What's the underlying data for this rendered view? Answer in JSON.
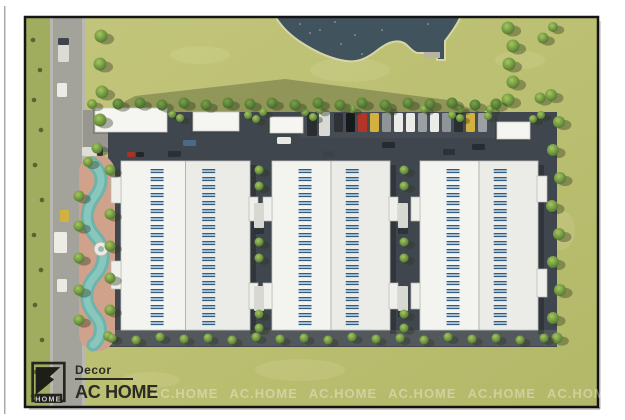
{
  "branding": {
    "brand_top": "Decor",
    "brand_main": "AC HOME",
    "logo_square_text": "HOME",
    "watermark_text": "AC.HOME",
    "watermark_count": 7
  },
  "palette": {
    "grass_base": "#bcc073",
    "grass_left": "#a0ac5e",
    "road": "#a3a29b",
    "sidewalk": "#b9b8b0",
    "asphalt": "#3f464e",
    "asphalt_light": "#454c53",
    "path_bottom": "#53585c",
    "pond": "#41545e",
    "shore": "#d9d5a8",
    "roof": "#f3f3f0",
    "roof_line": "#b4b4ae",
    "skylight_blue": "#2d5d86",
    "pool_teal": "#6fb3ab",
    "pool_teal_light": "#8eccc3",
    "pool_deck": "#d0a18b",
    "logo_dark": "#23231d"
  },
  "scene": {
    "frame": {
      "x": 25,
      "y": 17,
      "w": 573,
      "h": 390
    },
    "shadow_poly": "105,112 480,112 448,100 285,79 135,96",
    "pond_path": "M275,16 C282,28 291,36 302,43 C316,52 331,59 346,61 C359,63 369,57 379,49 C387,43 396,39 404,43 C409,46 411,51 417,53 L437,53 L437,60 L445,60 L445,41 C451,33 457,25 461,16 Z",
    "pond_dock": [
      424,
      52,
      16,
      6
    ],
    "pond_sparkles": [
      [
        320,
        30
      ],
      [
        300,
        24
      ],
      [
        341,
        44
      ],
      [
        362,
        54
      ],
      [
        382,
        30
      ],
      [
        428,
        24
      ],
      [
        335,
        22
      ],
      [
        355,
        35
      ],
      [
        310,
        33
      ]
    ],
    "grass_patches": [
      [
        350,
        70,
        80,
        24
      ],
      [
        200,
        55,
        60,
        18
      ],
      [
        480,
        200,
        70,
        26
      ],
      [
        300,
        370,
        90,
        22
      ],
      [
        150,
        380,
        60,
        16
      ],
      [
        520,
        60,
        50,
        18
      ],
      [
        560,
        230,
        30,
        40
      ]
    ],
    "pool": {
      "deck": [
        79,
        155,
        36,
        196
      ],
      "water_path": "M92,163 C103,172 104,184 95,196 C85,209 84,224 95,236 C106,248 106,264 95,276 C84,288 84,304 95,316 C103,325 102,338 93,345",
      "fountain": [
        101,
        249
      ]
    },
    "buildings": [
      {
        "x": 121,
        "y": 161,
        "w": 129,
        "h": 169
      },
      {
        "x": 272,
        "y": 161,
        "w": 118,
        "h": 169
      },
      {
        "x": 420,
        "y": 161,
        "w": 118,
        "h": 169
      }
    ],
    "dash": {
      "count": 20,
      "col_fracs": [
        0.28,
        0.68
      ],
      "w": 13,
      "top": 169,
      "bottom": 321
    },
    "north_buildings": [
      [
        95,
        108,
        72,
        24
      ],
      [
        193,
        112,
        46,
        19
      ],
      [
        270,
        117,
        33,
        16
      ],
      [
        497,
        122,
        33,
        17
      ]
    ],
    "docks": [
      [
        111,
        177,
        10,
        26
      ],
      [
        111,
        261,
        10,
        28
      ],
      [
        249,
        197,
        9,
        24
      ],
      [
        249,
        283,
        9,
        26
      ],
      [
        263,
        197,
        9,
        24
      ],
      [
        263,
        283,
        9,
        26
      ],
      [
        389,
        197,
        9,
        24
      ],
      [
        389,
        283,
        9,
        26
      ],
      [
        411,
        197,
        9,
        24
      ],
      [
        411,
        283,
        9,
        26
      ],
      [
        537,
        176,
        10,
        26
      ],
      [
        537,
        269,
        10,
        28
      ]
    ],
    "alley_trucks": [
      [
        254,
        203
      ],
      [
        254,
        286
      ],
      [
        398,
        203
      ],
      [
        398,
        286
      ]
    ],
    "parking": {
      "x": 334,
      "y": 113,
      "step": 12,
      "w": 9,
      "h": 19,
      "colors": [
        "#2e3237",
        "#17191d",
        "#b33527",
        "#d2b13e",
        "#8f9498",
        "#ebebe8",
        "#ebebe8",
        "#9aa0a4",
        "#ebebe8",
        "#8f9498",
        "#2a2f34",
        "#d2b13e",
        "#9aa0a4"
      ]
    },
    "parking_trucks": [
      [
        307,
        113,
        10,
        23,
        "#2a2e33"
      ],
      [
        319,
        112,
        11,
        24,
        "#d9d9d5"
      ]
    ],
    "aisle_cars": [
      [
        183,
        140,
        13,
        6,
        "#4a6a88"
      ],
      [
        168,
        151,
        13,
        6,
        "#2b3036"
      ],
      [
        127,
        152,
        8,
        5,
        "#a93226"
      ],
      [
        136,
        152,
        8,
        5,
        "#23272b"
      ],
      [
        277,
        137,
        14,
        7,
        "#e8e8e5"
      ],
      [
        382,
        142,
        13,
        6,
        "#272b30"
      ],
      [
        323,
        151,
        11,
        6,
        "#3c4248"
      ],
      [
        472,
        144,
        13,
        6,
        "#272c31"
      ],
      [
        443,
        149,
        12,
        6,
        "#2d3237"
      ]
    ],
    "road_vehicles": [
      [
        58,
        38,
        11,
        7,
        "#3f444a"
      ],
      [
        58,
        45,
        11,
        17,
        "#dcdcd7"
      ],
      [
        57,
        83,
        10,
        14,
        "#ebebe8"
      ],
      [
        82,
        147,
        15,
        9,
        "#deded9"
      ],
      [
        97,
        147,
        6,
        9,
        "#33383d"
      ],
      [
        60,
        210,
        9,
        12,
        "#d2b13e"
      ],
      [
        57,
        279,
        10,
        13,
        "#e9e9e6"
      ],
      [
        54,
        232,
        13,
        21,
        "#edece7"
      ]
    ],
    "trees": [
      [
        101,
        36,
        6.5
      ],
      [
        100,
        64,
        6.5
      ],
      [
        102,
        92,
        6.5
      ],
      [
        100,
        120,
        6.5
      ],
      [
        97,
        148,
        5.5
      ],
      [
        508,
        28,
        6.5
      ],
      [
        513,
        46,
        6.5
      ],
      [
        509,
        64,
        6.5
      ],
      [
        513,
        82,
        6.5
      ],
      [
        508,
        100,
        6.5
      ],
      [
        543,
        38,
        5.5
      ],
      [
        553,
        27,
        5
      ],
      [
        540,
        98,
        5.5
      ],
      [
        551,
        95,
        6
      ],
      [
        559,
        122,
        6
      ],
      [
        553,
        150,
        6
      ],
      [
        560,
        178,
        6
      ],
      [
        552,
        206,
        6
      ],
      [
        559,
        234,
        6
      ],
      [
        553,
        262,
        6
      ],
      [
        560,
        290,
        6
      ],
      [
        553,
        318,
        6
      ],
      [
        557,
        338,
        5.5
      ],
      [
        88,
        162,
        5
      ],
      [
        79,
        196,
        5.5
      ],
      [
        110,
        170,
        5.5
      ],
      [
        79,
        226,
        5.5
      ],
      [
        110,
        214,
        5.5
      ],
      [
        79,
        258,
        5.5
      ],
      [
        110,
        246,
        5.5
      ],
      [
        79,
        290,
        5.5
      ],
      [
        110,
        278,
        5.5
      ],
      [
        79,
        320,
        5.5
      ],
      [
        110,
        310,
        5.5
      ],
      [
        108,
        336,
        5
      ],
      [
        259,
        170,
        4.5
      ],
      [
        259,
        186,
        4.5
      ],
      [
        259,
        242,
        4.5
      ],
      [
        259,
        258,
        4.5
      ],
      [
        259,
        314,
        4.5
      ],
      [
        259,
        328,
        4.5
      ],
      [
        404,
        170,
        4.5
      ],
      [
        404,
        186,
        4.5
      ],
      [
        404,
        242,
        4.5
      ],
      [
        404,
        258,
        4.5
      ],
      [
        404,
        314,
        4.5
      ],
      [
        404,
        328,
        4.5
      ],
      [
        112,
        338,
        4.5
      ],
      [
        136,
        340,
        4.5
      ],
      [
        160,
        337,
        4.5
      ],
      [
        184,
        339,
        4.5
      ],
      [
        208,
        338,
        4.5
      ],
      [
        232,
        340,
        4.5
      ],
      [
        256,
        337,
        4.5
      ],
      [
        280,
        339,
        4.5
      ],
      [
        304,
        338,
        4.5
      ],
      [
        328,
        340,
        4.5
      ],
      [
        352,
        337,
        4.5
      ],
      [
        376,
        339,
        4.5
      ],
      [
        400,
        338,
        4.5
      ],
      [
        424,
        340,
        4.5
      ],
      [
        448,
        337,
        4.5
      ],
      [
        472,
        339,
        4.5
      ],
      [
        496,
        338,
        4.5
      ],
      [
        520,
        340,
        4.5
      ],
      [
        544,
        338,
        4.5
      ],
      [
        172,
        114,
        4
      ],
      [
        180,
        118,
        4
      ],
      [
        248,
        115,
        4
      ],
      [
        256,
        119,
        4
      ],
      [
        263,
        112,
        4
      ],
      [
        305,
        112,
        4
      ],
      [
        313,
        117,
        4
      ],
      [
        320,
        110,
        4
      ],
      [
        452,
        115,
        4
      ],
      [
        460,
        118,
        4
      ],
      [
        488,
        116,
        4
      ],
      [
        533,
        119,
        4
      ],
      [
        541,
        115,
        4
      ],
      [
        352,
        109,
        4
      ],
      [
        388,
        109,
        4
      ],
      [
        424,
        109,
        4
      ],
      [
        460,
        109,
        4
      ],
      [
        490,
        109,
        4
      ],
      [
        92,
        104,
        5
      ]
    ],
    "palms": [
      [
        118,
        104,
        5.5
      ],
      [
        140,
        103,
        5.5
      ],
      [
        162,
        105,
        5.5
      ],
      [
        184,
        103,
        5.5
      ],
      [
        206,
        105,
        5.5
      ],
      [
        228,
        103,
        5.5
      ],
      [
        250,
        104,
        5.5
      ],
      [
        272,
        103,
        5.5
      ],
      [
        295,
        105,
        5.5
      ],
      [
        318,
        103,
        5.5
      ],
      [
        340,
        105,
        5.5
      ],
      [
        362,
        103,
        5.5
      ],
      [
        385,
        105,
        5.5
      ],
      [
        408,
        103,
        5.5
      ],
      [
        430,
        104,
        5.5
      ],
      [
        452,
        103,
        5.5
      ],
      [
        475,
        105,
        5.5
      ],
      [
        496,
        104,
        5.5
      ]
    ],
    "shrubs": [
      [
        33,
        40
      ],
      [
        40,
        70
      ],
      [
        34,
        100
      ],
      [
        41,
        130
      ],
      [
        35,
        165
      ],
      [
        42,
        200
      ],
      [
        34,
        235
      ],
      [
        41,
        270
      ],
      [
        35,
        305
      ],
      [
        42,
        340
      ],
      [
        36,
        372
      ],
      [
        33,
        396
      ]
    ]
  }
}
